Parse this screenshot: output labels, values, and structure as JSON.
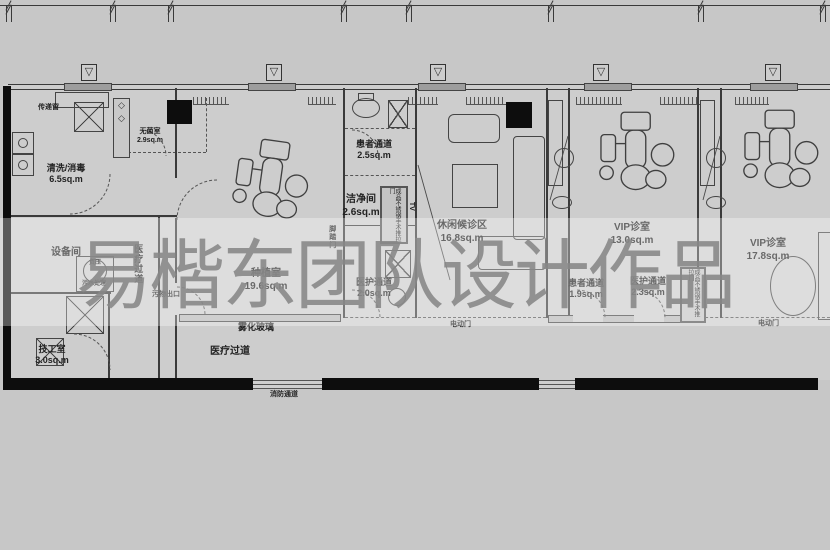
{
  "watermark": {
    "text": "易楷东团队设计作品",
    "color": "#878787"
  },
  "icons": {
    "level_marker": "▽",
    "diamond": "◇"
  },
  "plan": {
    "rooms": [
      {
        "name": "清洗/消毒",
        "area": "6.5sq.m"
      },
      {
        "name": "无菌室",
        "area": "2.9sq.m"
      },
      {
        "name": "设备间",
        "area": ""
      },
      {
        "name": "技工室",
        "area": "3.0sq.m"
      },
      {
        "name": "种植室",
        "area": "19.6sq.m"
      },
      {
        "name": "患者通道",
        "area": "2.5sq.m"
      },
      {
        "name": "洁净间",
        "area": "2.6sq.m"
      },
      {
        "name": "医护通道",
        "area": "2.0sq.m"
      },
      {
        "name": "休闲候诊区",
        "area": "16.8sq.m"
      },
      {
        "name": "VIP诊室",
        "area": "13.0sq.m"
      },
      {
        "name": "患者通道",
        "area": "1.9sq.m"
      },
      {
        "name": "医护通道",
        "area": "2.3sq.m"
      },
      {
        "name": "VIP诊室",
        "area": "17.8sq.m"
      }
    ],
    "annotations": {
      "chuan_di_chuang": "传递窗",
      "wu_shui_chu_li": "污水处理",
      "fu_ya": "负压",
      "yi_liao_guo_dao": "医疗过道",
      "wu_wu_chu_kou": "污物出口",
      "wu_hua_bo_li": "雾化玻璃",
      "xiao_fang_tong_dao": "消防通道",
      "jiao_ta_men": "脚踏门",
      "steel_door": "成品不锈钢手术推拉门",
      "tv": "TV",
      "dian_dong_men": "电动门"
    }
  }
}
